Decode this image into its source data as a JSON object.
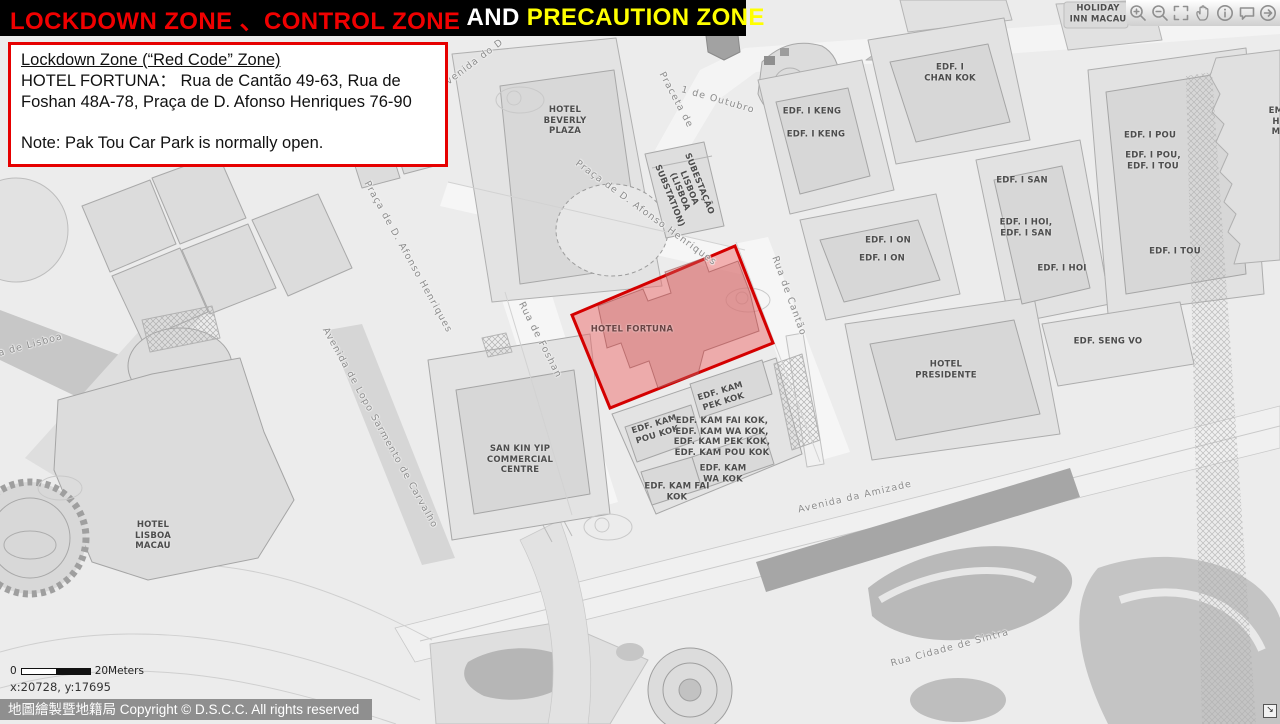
{
  "title_bar": {
    "segments": [
      {
        "text": "LOCKDOWN ZONE 、CONTROL ZONE",
        "color": "#f00000"
      },
      {
        "text": " AND ",
        "color": "#ffffff"
      },
      {
        "text": "PRECAUTION ZONE",
        "color": "#ffff00"
      }
    ]
  },
  "info_box": {
    "heading": "Lockdown Zone (“Red Code” Zone)",
    "body": "HOTEL FORTUNA：  Rua de Cantão 49-63, Rua de Foshan 48A-78, Praça de D. Afonso Henriques 76-90",
    "note": "Note: Pak Tou Car Park is normally open."
  },
  "toolbar": {
    "icons": [
      {
        "name": "zoom-in-icon"
      },
      {
        "name": "zoom-out-icon"
      },
      {
        "name": "fullscreen-icon"
      },
      {
        "name": "pan-icon"
      },
      {
        "name": "info-icon"
      },
      {
        "name": "comment-icon"
      },
      {
        "name": "arrow-icon"
      }
    ]
  },
  "colors": {
    "title_red": "#f00000",
    "title_yellow": "#ffff00",
    "info_border_red": "#e60000",
    "zone_stroke": "#d40000",
    "zone_fill": "rgba(237,106,106,0.5)"
  },
  "map": {
    "zone_label": "HOTEL FORTUNA",
    "building_labels": [
      {
        "name": "label-hotel-beverly-plaza",
        "lines": [
          "HOTEL",
          "BEVERLY",
          "PLAZA"
        ],
        "x": 565,
        "y": 121
      },
      {
        "name": "label-substation",
        "lines": [
          "SUBESTAÇÃO",
          "LISBOA",
          "(LISBOA",
          "SUBSTATION)"
        ],
        "x": 684,
        "y": 190,
        "rotate": 68
      },
      {
        "name": "label-hotel-fortuna",
        "lines": [
          "HOTEL FORTUNA"
        ],
        "x": 632,
        "y": 330,
        "color": "#6b4343"
      },
      {
        "name": "label-edf-i-keng-1",
        "lines": [
          "EDF. I KENG"
        ],
        "x": 812,
        "y": 112
      },
      {
        "name": "label-edf-i-keng-2",
        "lines": [
          "EDF. I KENG"
        ],
        "x": 816,
        "y": 135
      },
      {
        "name": "label-edf-i-chan-kok",
        "lines": [
          "EDF. I",
          "CHAN KOK"
        ],
        "x": 950,
        "y": 73
      },
      {
        "name": "label-edf-i-on-1",
        "lines": [
          "EDF. I ON"
        ],
        "x": 888,
        "y": 241
      },
      {
        "name": "label-edf-i-on-2",
        "lines": [
          "EDF. I ON"
        ],
        "x": 882,
        "y": 259
      },
      {
        "name": "label-edf-i-san",
        "lines": [
          "EDF. I SAN"
        ],
        "x": 1022,
        "y": 181
      },
      {
        "name": "label-edf-i-hoi-i-san",
        "lines": [
          "EDF. I HOI,",
          "EDF. I SAN"
        ],
        "x": 1026,
        "y": 228
      },
      {
        "name": "label-edf-i-hoi",
        "lines": [
          "EDF. I HOI"
        ],
        "x": 1062,
        "y": 269
      },
      {
        "name": "label-edf-i-pou",
        "lines": [
          "EDF. I POU"
        ],
        "x": 1150,
        "y": 136
      },
      {
        "name": "label-edf-i-pou-i-tou",
        "lines": [
          "EDF. I POU,",
          "EDF. I TOU"
        ],
        "x": 1153,
        "y": 161
      },
      {
        "name": "label-edf-i-tou",
        "lines": [
          "EDF. I TOU"
        ],
        "x": 1175,
        "y": 252
      },
      {
        "name": "label-edf-seng-vo",
        "lines": [
          "EDF. SENG VO"
        ],
        "x": 1108,
        "y": 342
      },
      {
        "name": "label-hotel-presidente",
        "lines": [
          "HOTEL",
          "PRESIDENTE"
        ],
        "x": 946,
        "y": 370
      },
      {
        "name": "label-edf-kam-pek-kok",
        "lines": [
          "EDF. KAM",
          "PEK KOK"
        ],
        "x": 722,
        "y": 397,
        "rotate": -17
      },
      {
        "name": "label-edf-kam-pou-kok",
        "lines": [
          "EDF. KAM",
          "POU KOK"
        ],
        "x": 656,
        "y": 430,
        "rotate": -17
      },
      {
        "name": "label-edf-kam-group",
        "lines": [
          "EDF. KAM FAI KOK,",
          "EDF. KAM WA KOK,",
          "EDF. KAM PEK KOK,",
          "EDF. KAM POU KOK"
        ],
        "x": 722,
        "y": 437
      },
      {
        "name": "label-edf-kam-wa-kok",
        "lines": [
          "EDF. KAM",
          "WA KOK"
        ],
        "x": 723,
        "y": 474
      },
      {
        "name": "label-edf-kam-fai-kok",
        "lines": [
          "EDF. KAM FAI",
          "KOK"
        ],
        "x": 677,
        "y": 492
      },
      {
        "name": "label-san-kin-yip",
        "lines": [
          "SAN KIN YIP",
          "COMMERCIAL",
          "CENTRE"
        ],
        "x": 520,
        "y": 460
      },
      {
        "name": "label-hotel-lisboa-macau",
        "lines": [
          "HOTEL",
          "LISBOA",
          "MACAU"
        ],
        "x": 153,
        "y": 536
      },
      {
        "name": "label-holiday-inn-macau",
        "lines": [
          "HOLIDAY",
          "INN MACAU"
        ],
        "x": 1098,
        "y": 14
      },
      {
        "name": "label-edge-building",
        "lines": [
          "EM",
          "H",
          "M"
        ],
        "x": 1276,
        "y": 122
      }
    ],
    "street_labels": [
      {
        "name": "street-avenida-do-d",
        "text": "Avenida do D",
        "x": 472,
        "y": 64,
        "rotate": -37
      },
      {
        "name": "street-praceta-de",
        "text": "Praceta de",
        "x": 676,
        "y": 100,
        "rotate": 62
      },
      {
        "name": "street-1-de-outubro",
        "text": "1 de Outubro",
        "x": 718,
        "y": 100,
        "rotate": 16
      },
      {
        "name": "street-praca-afonso-henriques-upper",
        "text": "Praça de D. Afonso Henriques",
        "x": 646,
        "y": 213,
        "rotate": 36
      },
      {
        "name": "street-praca-afonso-henriques-left",
        "text": "Praça de D. Afonso Henriques",
        "x": 408,
        "y": 257,
        "rotate": 61
      },
      {
        "name": "street-rua-de-foshan",
        "text": "Rua de Foshan",
        "x": 540,
        "y": 340,
        "rotate": 63
      },
      {
        "name": "street-rua-de-cantao",
        "text": "Rua de Cantão",
        "x": 789,
        "y": 296,
        "rotate": 70
      },
      {
        "name": "street-avenida-lopo-sarmento",
        "text": "Avenida de Lopo Sarmento de Carvalho",
        "x": 380,
        "y": 428,
        "rotate": 61
      },
      {
        "name": "street-avenida-de-lisboa",
        "text": "Avenida de Lisboa",
        "x": 12,
        "y": 350,
        "rotate": -15
      },
      {
        "name": "street-avenida-da-amizade",
        "text": "Avenida da Amizade",
        "x": 855,
        "y": 497,
        "rotate": -13
      },
      {
        "name": "street-rua-cidade-de-sintra",
        "text": "Rua Cidade de Sintra",
        "x": 950,
        "y": 648,
        "rotate": -15
      }
    ],
    "scale": {
      "zero": "0",
      "label": "20Meters"
    },
    "coordinates": "x:20728, y:17695"
  },
  "footer": {
    "copyright": "地圖繪製暨地籍局 Copyright © D.S.C.C. All rights reserved"
  },
  "resize_handle_glyph": "↘"
}
